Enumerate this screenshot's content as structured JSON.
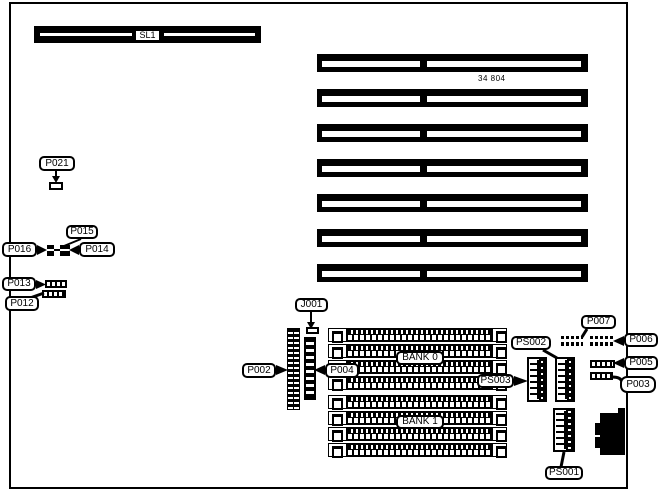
{
  "board": {
    "part_number": "34 804",
    "background_color": "#ffffff",
    "line_color": "#000000"
  },
  "slots": {
    "bus_slot_label": "SL1",
    "expansion_slot_count": 7
  },
  "memory": {
    "bank0_label": "BANK 0",
    "bank1_label": "BANK 1",
    "sockets_per_bank": 4
  },
  "labels": {
    "sl1": "SL1",
    "p021": "P021",
    "p015": "P015",
    "p016": "P016",
    "p014": "P014",
    "p013": "P013",
    "p012": "P012",
    "j001": "J001",
    "p002": "P002",
    "p004": "P004",
    "bank0": "BANK 0",
    "bank1": "BANK 1",
    "ps002": "PS002",
    "ps003": "PS003",
    "ps001": "PS001",
    "p007": "P007",
    "p006": "P006",
    "p005": "P005",
    "p003": "P003"
  }
}
